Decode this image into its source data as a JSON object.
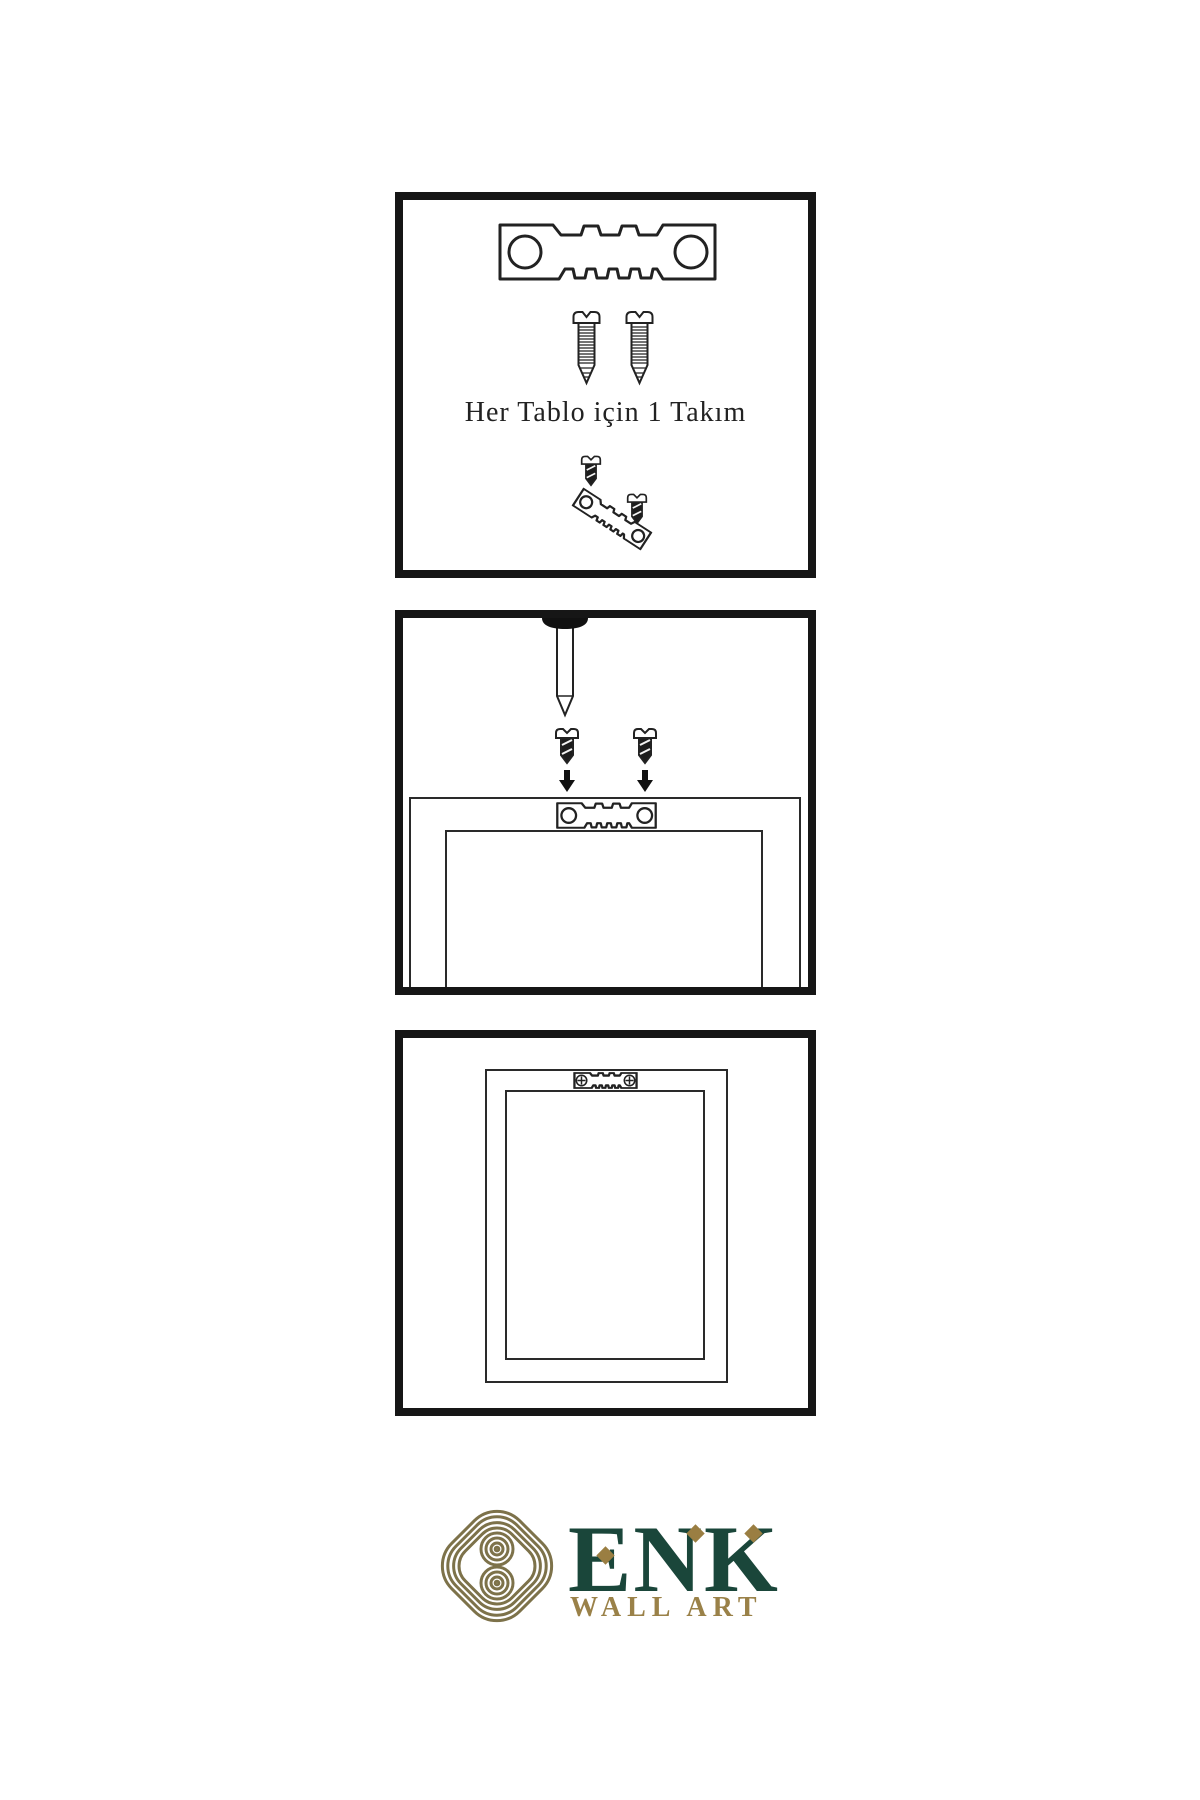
{
  "title": "wall-art-hanging-instructions",
  "colors": {
    "line": "#1e1e1e",
    "brand_green": "#1a463a",
    "brand_gold": "#9a8148",
    "knot_gold": "#7d724a"
  },
  "panels": {
    "hardware_set": {
      "caption": "Her Tablo için 1 Takım",
      "items": [
        "sawtooth-hanger-icon",
        "screw-icon",
        "screw-icon",
        "dark-screw-icon",
        "angled-sawtooth-hanger-icon",
        "dark-screw-icon"
      ]
    },
    "wall_mounting": {
      "items": [
        "wall-nail-icon",
        "dark-screw-icon",
        "down-arrow-icon",
        "dark-screw-icon",
        "down-arrow-icon",
        "frame-back",
        "sawtooth-hanger-icon"
      ]
    },
    "hanging_result": {
      "items": [
        "frame-back",
        "sawtooth-hanger-icon",
        "phillips-screw-icon",
        "phillips-screw-icon"
      ]
    }
  },
  "logo": {
    "brand": "ENK",
    "tagline": "WALL ART"
  }
}
